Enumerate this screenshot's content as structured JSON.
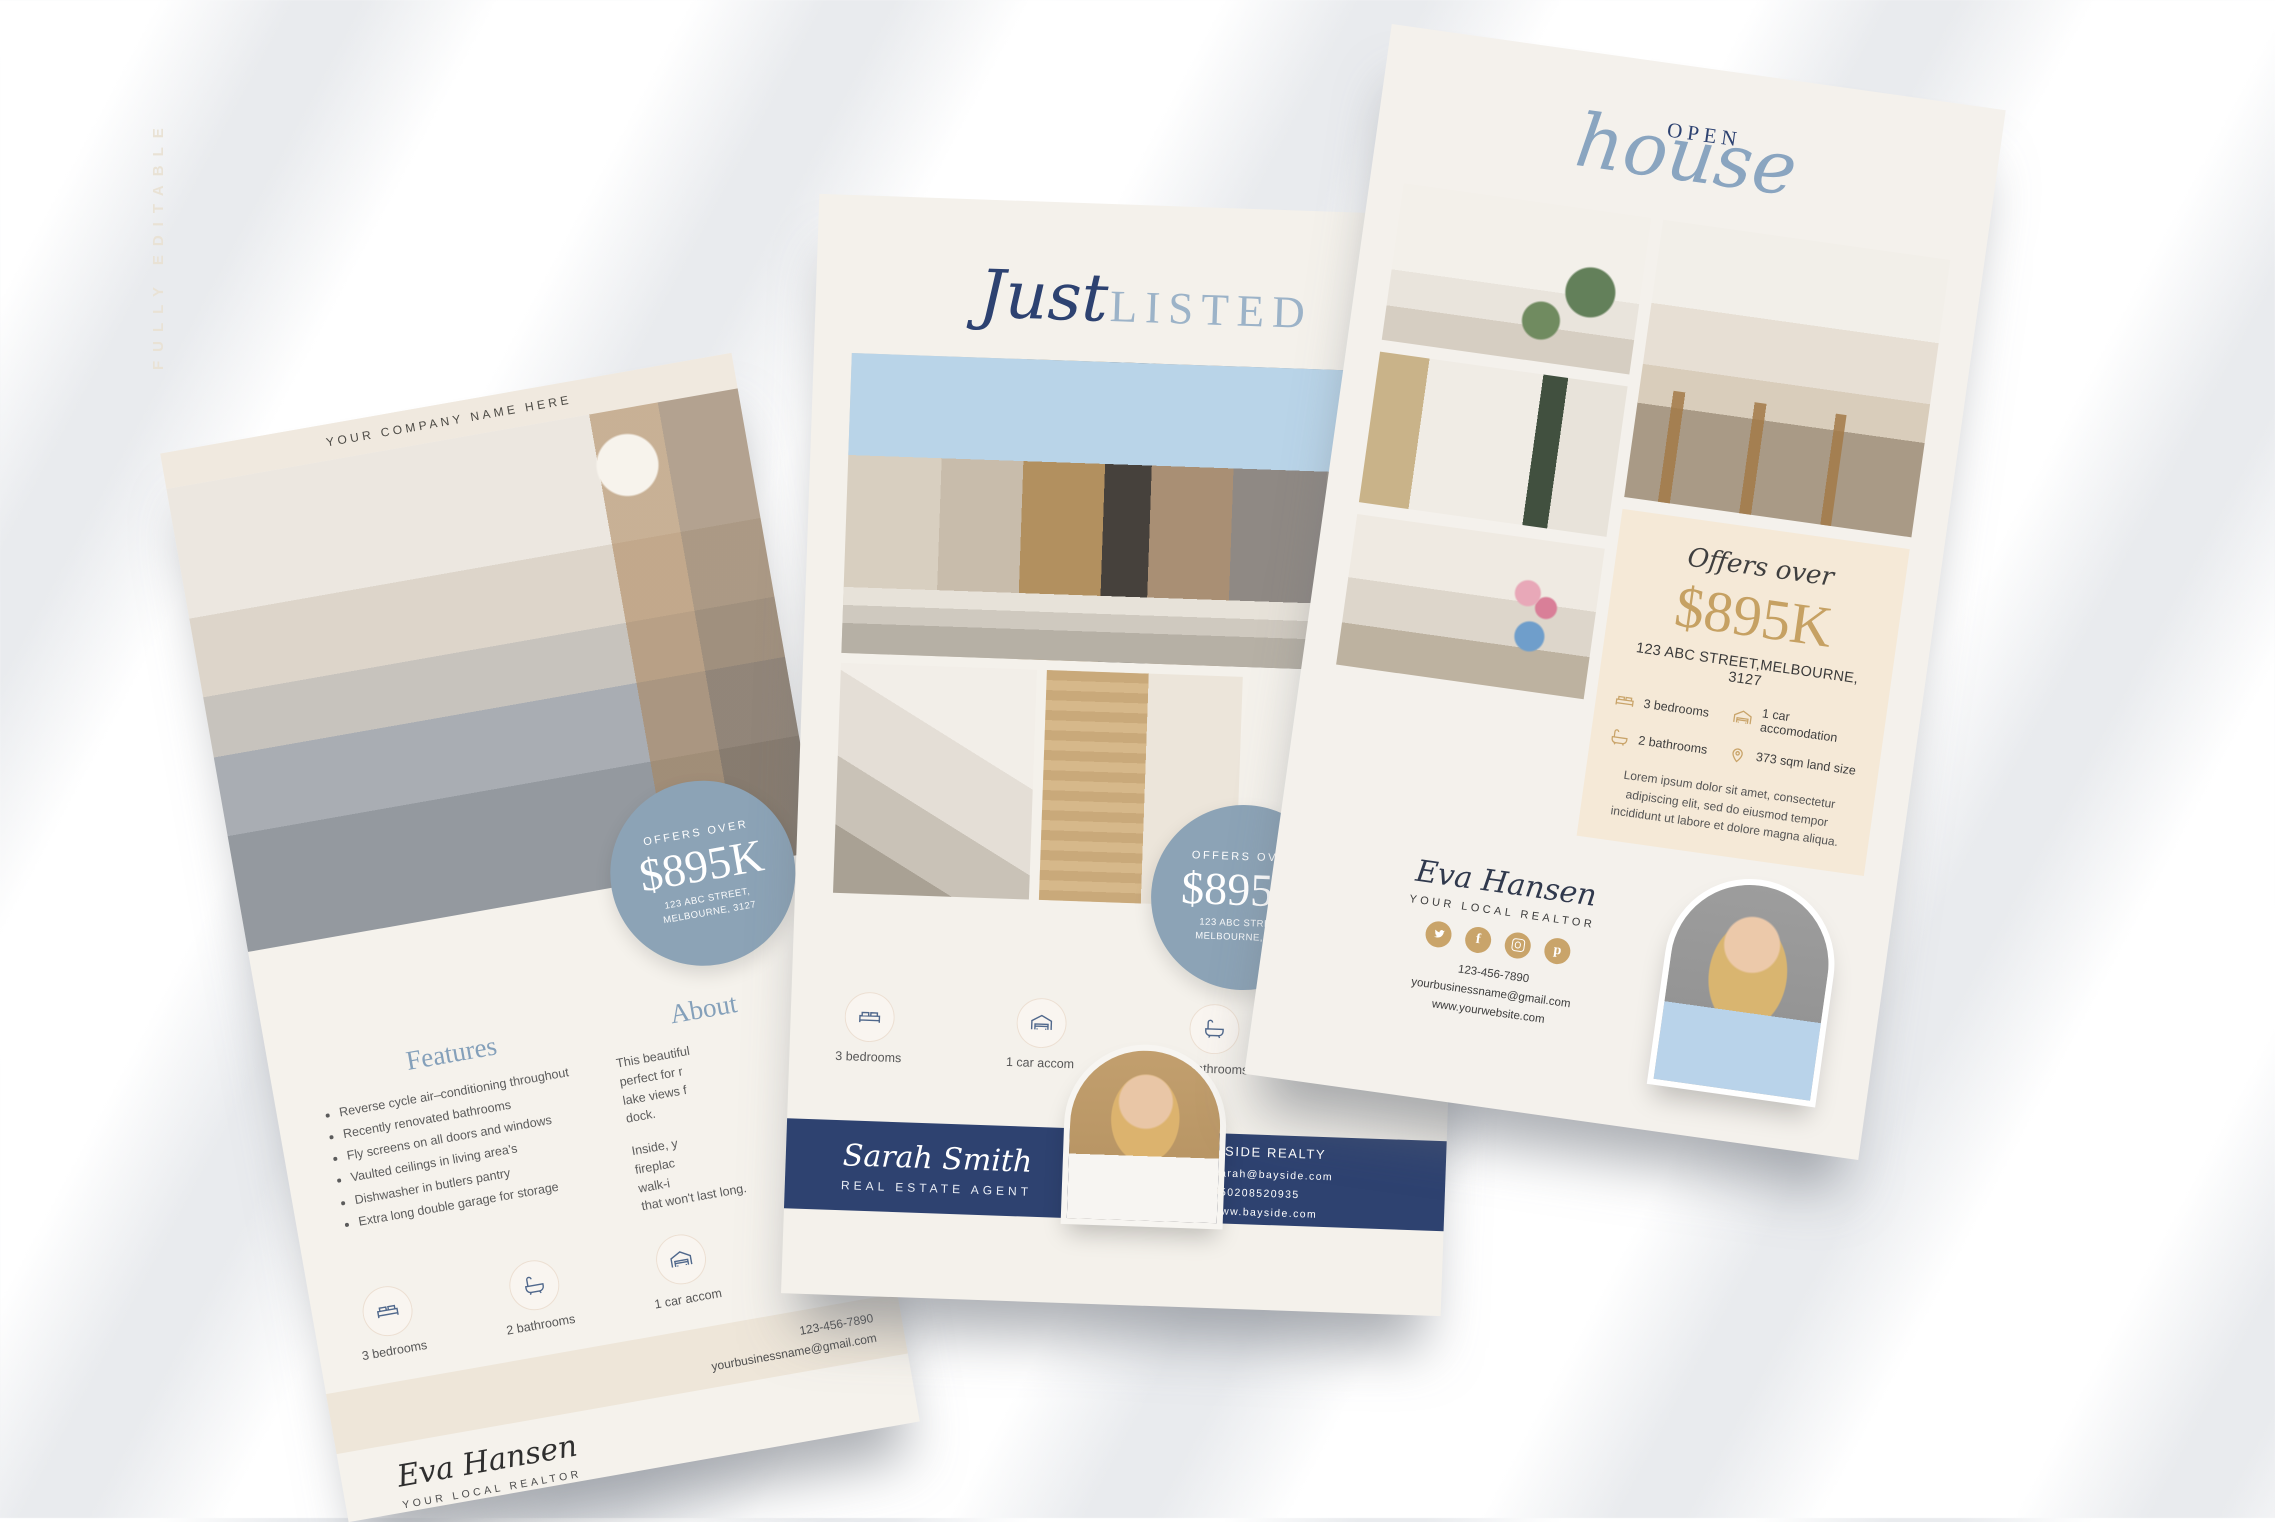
{
  "background": {
    "watermark": "FULLY EDITABLE"
  },
  "colors": {
    "navy": "#2e4270",
    "slate_badge": "#8ca3b6",
    "gold": "#c9a46a",
    "cream": "#f4f1ec",
    "beige_box": "#f5e9d7",
    "band_beige": "#eee6d9",
    "title_blue": "#9cb3c8",
    "heading_blue": "#84a0ba"
  },
  "left_flyer": {
    "company_header": "YOUR COMPANY NAME HERE",
    "badge": {
      "label": "OFFERS OVER",
      "price": "$895K",
      "address_line1": "123 ABC STREET,",
      "address_line2": "MELBOURNE, 3127"
    },
    "features": {
      "heading": "Features",
      "items": [
        "Reverse cycle air–conditioning throughout",
        "Recently renovated bathrooms",
        "Fly screens on all doors and windows",
        "Vaulted ceilings in living area's",
        "Dishwasher in butlers pantry",
        "Extra long double garage for storage"
      ]
    },
    "about": {
      "heading": "About",
      "para1_lines": [
        "This beautiful",
        "perfect for r",
        "lake views f",
        "dock."
      ],
      "para2_lines": [
        "Inside, y",
        "fireplac",
        "walk-i",
        "that won't last long."
      ]
    },
    "details": [
      {
        "icon": "bed",
        "label": "3 bedrooms"
      },
      {
        "icon": "bath",
        "label": "2 bathrooms"
      },
      {
        "icon": "garage",
        "label": "1 car accom"
      },
      {
        "icon": "pin",
        "label": "373 sqm"
      }
    ],
    "contact": {
      "phone": "123-456-7890",
      "email": "yourbusinessname@gmail.com"
    },
    "agent": {
      "name": "Eva Hansen",
      "title": "YOUR LOCAL REALTOR"
    }
  },
  "middle_flyer": {
    "title": {
      "script": "Just",
      "caps": "LISTED"
    },
    "badge": {
      "label": "OFFERS OVER",
      "price": "$895K",
      "address_line1": "123 ABC STREET,",
      "address_line2": "MELBOURNE, 3127"
    },
    "stamp": {
      "text": "YOUR LOGO HERE • YOUR LOGO HERE •",
      "icon": "camera"
    },
    "details": [
      {
        "icon": "bed",
        "label": "3 bedrooms"
      },
      {
        "icon": "garage",
        "label": "1 car accom"
      },
      {
        "icon": "bath",
        "label": "2 bathrooms"
      },
      {
        "icon": "pin",
        "label": "373 sqm"
      }
    ],
    "agent": {
      "name": "Sarah Smith",
      "title": "REAL ESTATE AGENT"
    },
    "company": {
      "name": "BAYSIDE REALTY",
      "email": "sarah@bayside.com",
      "phone": "050208520935",
      "website": "www.bayside.com"
    }
  },
  "right_flyer": {
    "title": {
      "caps": "OPEN",
      "script": "house"
    },
    "offer": {
      "label": "Offers over",
      "price": "$895K",
      "address": "123 ABC STREET,MELBOURNE, 3127"
    },
    "details": [
      {
        "icon": "bed",
        "label": "3 bedrooms"
      },
      {
        "icon": "garage",
        "label": "1 car accomodation"
      },
      {
        "icon": "bath",
        "label": "2 bathrooms"
      },
      {
        "icon": "pin",
        "label": "373 sqm land size"
      }
    ],
    "description": "Lorem ipsum dolor sit amet, consectetur adipiscing elit, sed do eiusmod tempor incididunt ut labore et dolore magna aliqua.",
    "agent": {
      "name": "Eva Hansen",
      "title": "YOUR LOCAL REALTOR",
      "phone": "123-456-7890",
      "email": "yourbusinessname@gmail.com",
      "website": "www.yourwebsite.com"
    },
    "social": [
      "twitter",
      "facebook",
      "instagram",
      "pinterest"
    ]
  }
}
